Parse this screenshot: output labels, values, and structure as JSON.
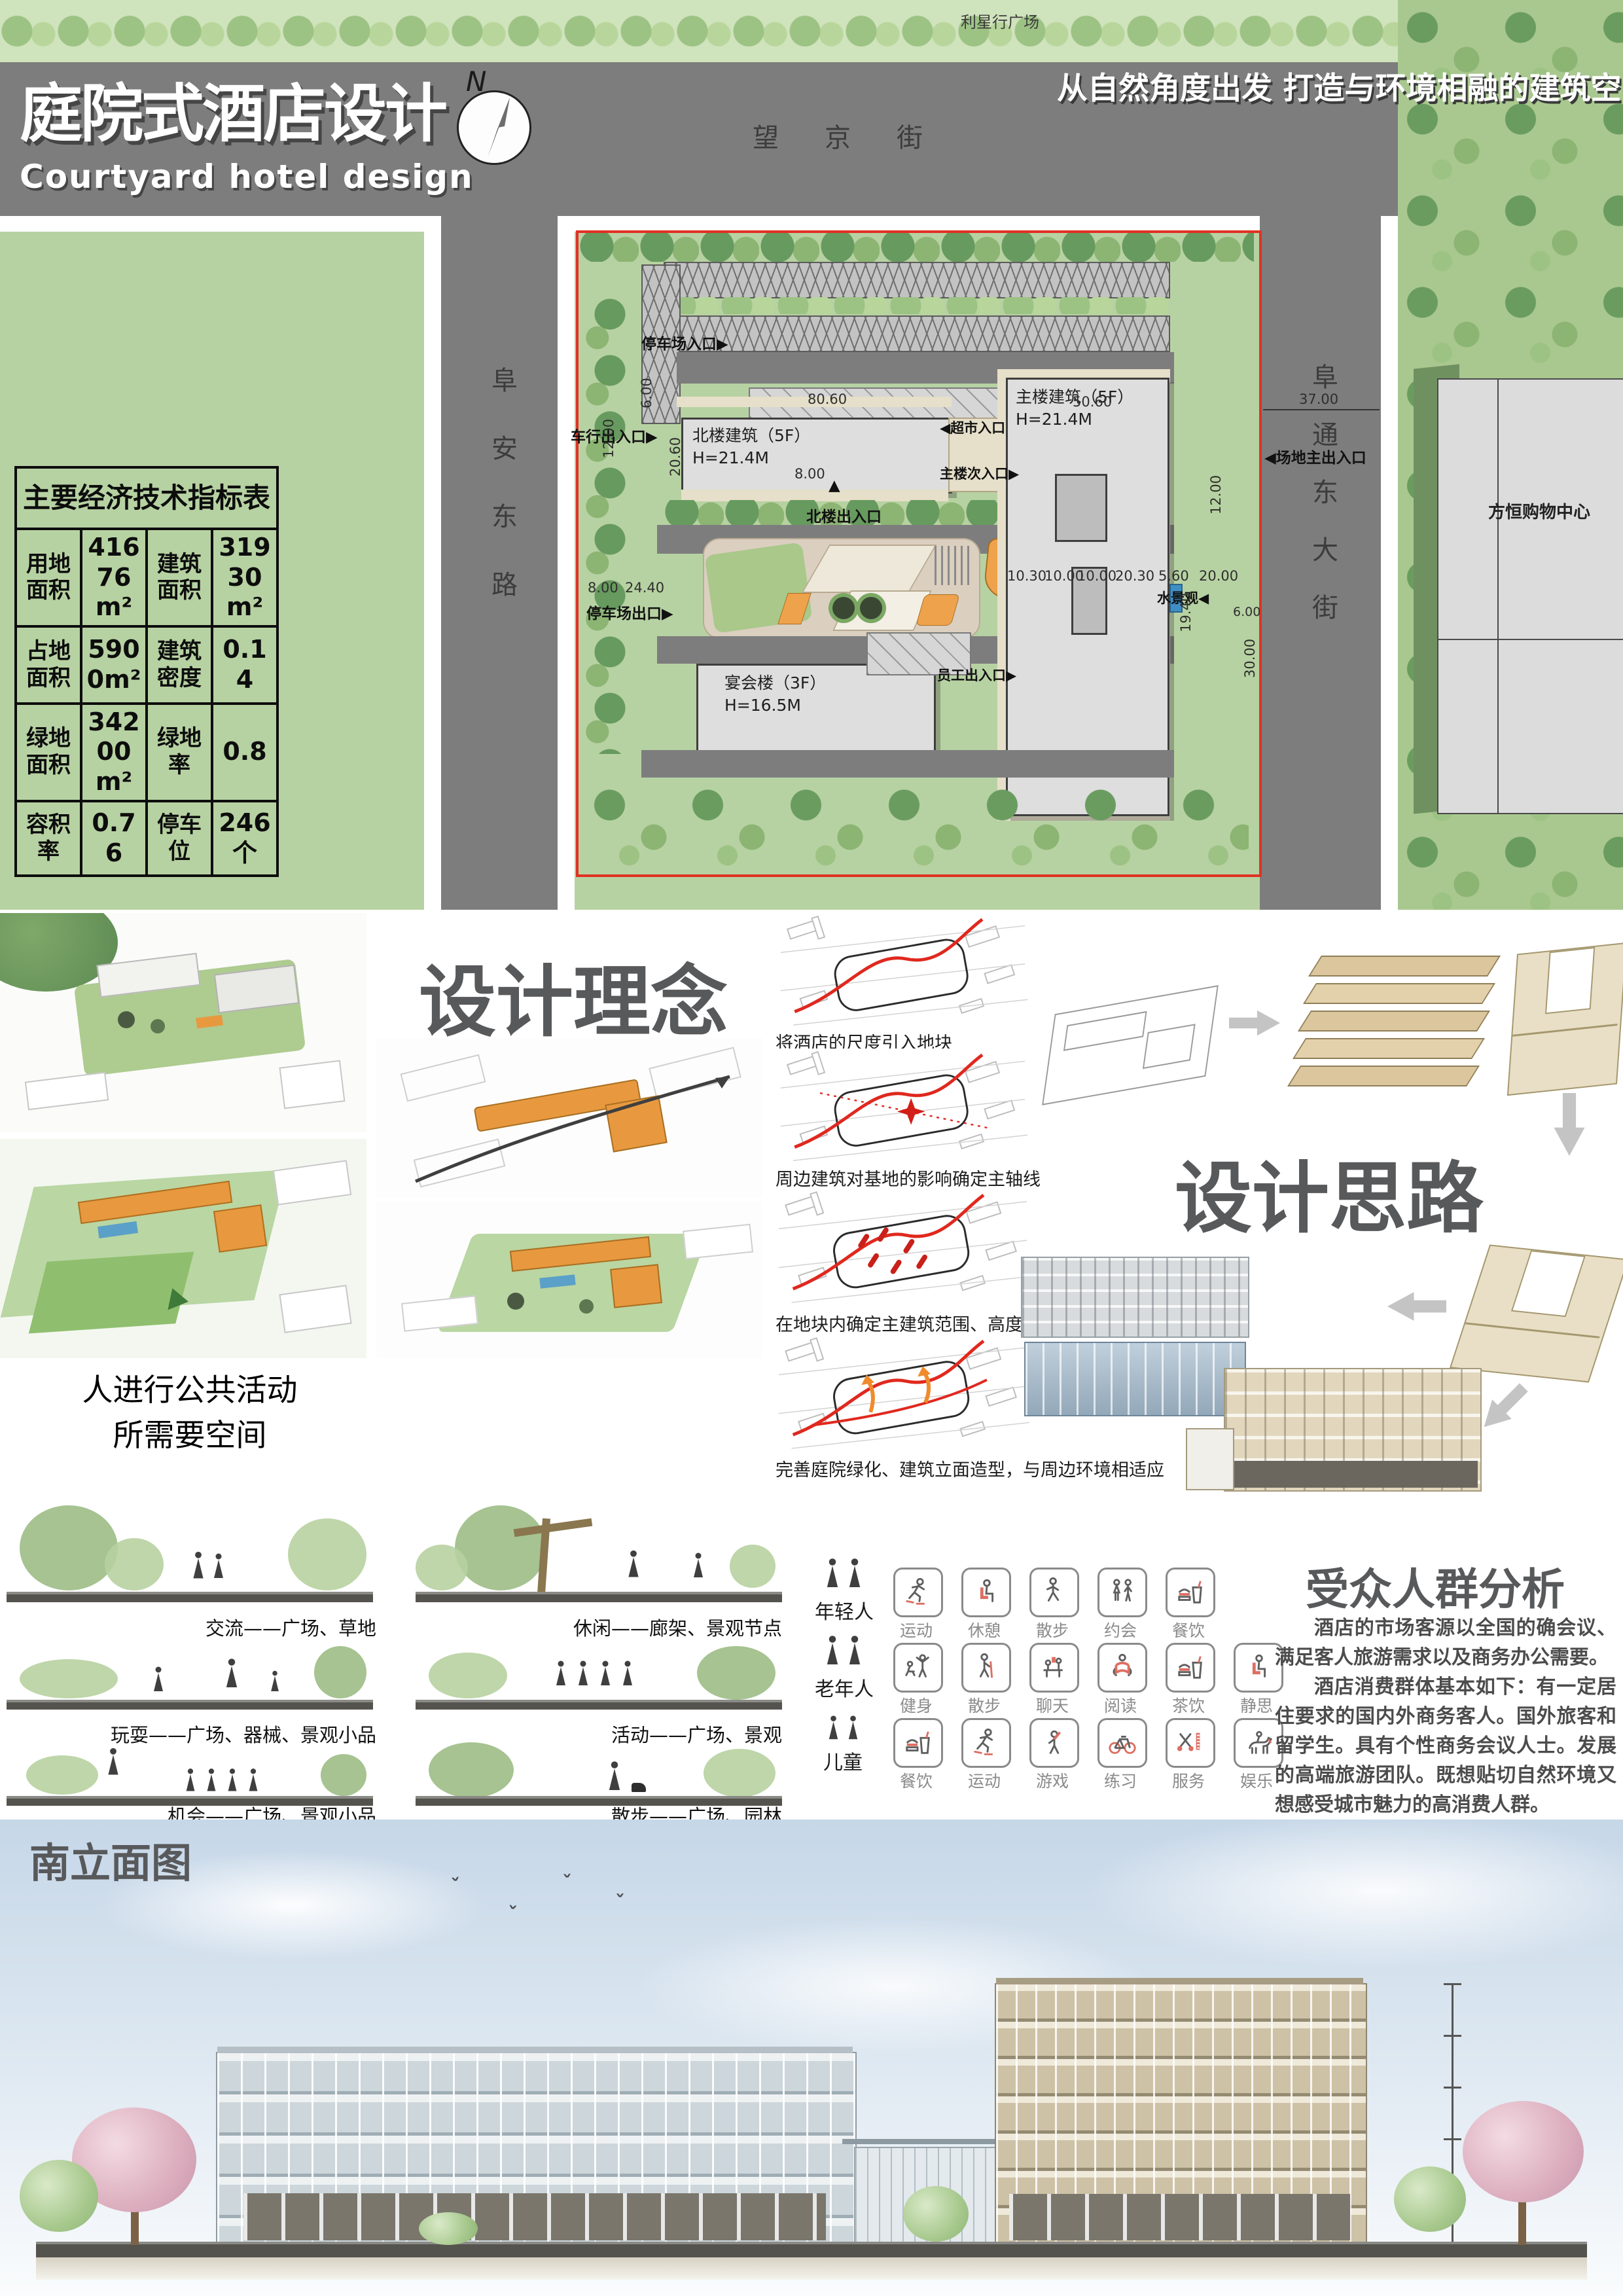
{
  "header": {
    "title_cn": "庭院式酒店设计",
    "title_en": "Courtyard hotel design",
    "slogan": "从自然角度出发 打造与环境相融的建筑空间",
    "compass_label": "N"
  },
  "site_plan": {
    "street_top_chars": [
      "望",
      "京",
      "街"
    ],
    "street_left": "阜安东路",
    "street_right": "阜通东大街",
    "neighbor_top": "利星行广场",
    "neighbor_right": "方恒购物中心",
    "buildings": {
      "north_name": "北楼建筑（5F）",
      "north_h": "H=21.4M",
      "main_name": "主楼建筑（5F）",
      "main_h": "H=21.4M",
      "banquet_name": "宴会楼（3F）",
      "banquet_h": "H=16.5M"
    },
    "entrances": {
      "parking_in": "停车场入口▶",
      "vehicle": "车行出入口▶",
      "parking_out": "停车场出口▶",
      "site_main": "◀场地主出入口",
      "supermarket": "◀超市入口",
      "main_secondary": "主楼次入口▶",
      "north_entry": "北楼出入口",
      "north_entry_arrow": "▲",
      "staff": "员工出入口▶",
      "water": "水景观◀"
    },
    "dims": [
      "80.60",
      "20.60",
      "8.00",
      "8.00",
      "6.00",
      "6.00",
      "24.40",
      "12.00",
      "12.00",
      "50.60",
      "37.00",
      "10.30",
      "10.00",
      "10.00",
      "20.30",
      "5.60",
      "20.00",
      "19.40",
      "30.00"
    ]
  },
  "indicator_table": {
    "title": "主要经济技术指标表",
    "rows": [
      {
        "l1": "用地面积",
        "v1": "41676m²",
        "l2": "建筑面积",
        "v2": "31930m²"
      },
      {
        "l1": "占地面积",
        "v1": "5900m²",
        "l2": "建筑密度",
        "v2": "0.14"
      },
      {
        "l1": "绿地面积",
        "v1": "34200m²",
        "l2": "绿地率",
        "v2": "0.8"
      },
      {
        "l1": "容积率",
        "v1": "0.76",
        "l2": "停车位",
        "v2": "246个"
      }
    ]
  },
  "design_concept": {
    "title": "设计理念",
    "note_line1": "人进行公共活动",
    "note_line2": "所需要空间",
    "steps": [
      "将酒店的尺度引入地块",
      "周边建筑对基地的影响确定主轴线",
      "在地块内确定主建筑范围、高度及绿化范围",
      "完善庭院绿化、建筑立面造型，与周边环境相适应"
    ]
  },
  "design_thinking": {
    "title": "设计思路"
  },
  "activity_sections": {
    "left": [
      "交流——广场、草地",
      "玩耍——广场、器械、景观小品",
      "机会——广场、景观小品"
    ],
    "middle": [
      "休闲——廊架、景观节点",
      "活动——广场、景观",
      "散步——广场、园林"
    ]
  },
  "audience": {
    "title": "受众人群分析",
    "para1": "酒店的市场客源以全国的确会议、满足客人旅游需求以及商务办公需要。",
    "para2": "酒店消费群体基本如下：有一定居住要求的国内外商务客人。国外旅客和留学生。具有个性商务会议人士。发展的高端旅游团队。既想贴切自然环境又想感受城市魅力的高消费人群。",
    "groups": [
      {
        "name": "年轻人",
        "items": [
          "运动",
          "休憩",
          "散步",
          "约会",
          "餐饮"
        ]
      },
      {
        "name": "老年人",
        "items": [
          "健身",
          "散步",
          "聊天",
          "阅读",
          "茶饮",
          "静思"
        ]
      },
      {
        "name": "儿童",
        "items": [
          "餐饮",
          "运动",
          "游戏",
          "练习",
          "服务",
          "娱乐"
        ]
      }
    ],
    "icon_names": {
      "young": [
        "skater-icon",
        "seated-person-icon",
        "walker-icon",
        "couple-icon",
        "food-drink-icon"
      ],
      "elderly": [
        "fitness-icon",
        "cane-walker-icon",
        "chat-icon",
        "reader-icon",
        "food-drink-icon",
        "seated-person-icon"
      ],
      "children": [
        "food-drink-icon",
        "skater-icon",
        "bat-player-icon",
        "bicycle-icon",
        "barber-icon",
        "horse-rider-icon"
      ]
    }
  },
  "elevation": {
    "title": "南立面图"
  },
  "colors": {
    "plan_green": "#b7d2a2",
    "road_gray": "#7d7d7d",
    "boundary_red": "#e03224",
    "accent_orange": "#e8a04b",
    "title_gray": "#58595b",
    "icon_accent": "#dc6f62",
    "sky_blue": "#ccdbea"
  }
}
